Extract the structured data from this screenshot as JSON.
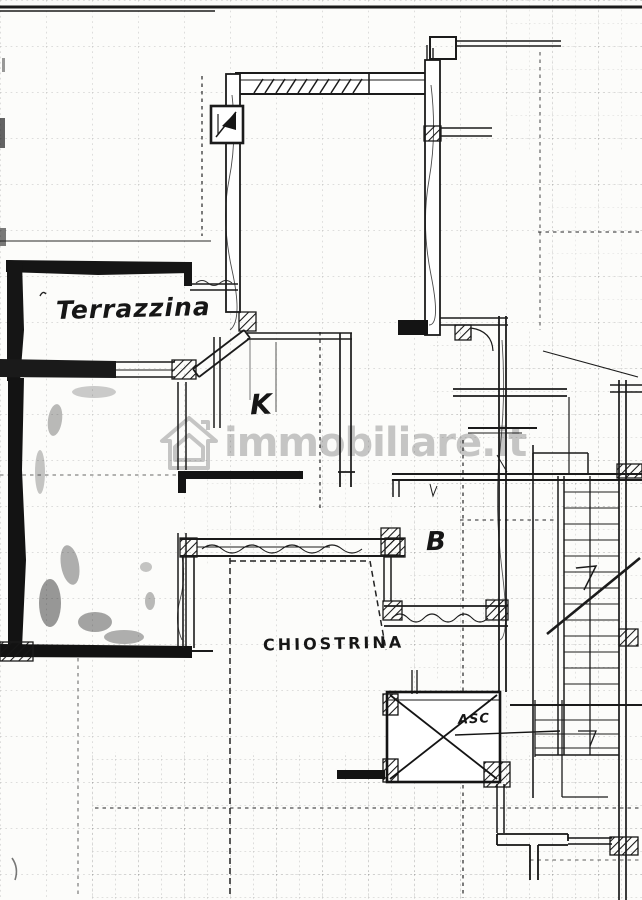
{
  "plan": {
    "labels": {
      "terrace": "Terrazzina",
      "kitchen": "K",
      "bathroom": "B",
      "lightwell": "CHIOSTRINA",
      "elevator": "ASC"
    },
    "watermark": {
      "text": "immobiliare.it"
    },
    "colors": {
      "ink": "#1b1b1b",
      "paper": "#fcfcfa",
      "watermark": "#7a7a7a"
    }
  }
}
